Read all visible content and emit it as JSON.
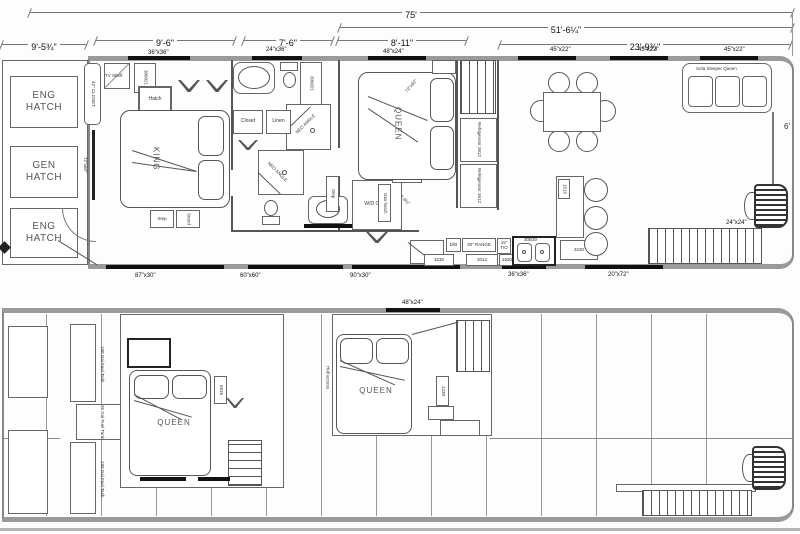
{
  "upper_deck": {
    "dims": {
      "overall": "75'",
      "cabin": "51'-6¼\"",
      "bow": "9'-5¾\"",
      "bed1": "9'-6\"",
      "bath": "7'-6\"",
      "bed2": "8'-11\"",
      "salon": "23'-9¾\"",
      "beam": "6'",
      "hall": "2'-6½\""
    },
    "windows_top": {
      "a": "36\"x36\"",
      "b": "24\"x36\"",
      "c": "48\"x24\"",
      "d": "45\"x22\"",
      "e": "45\"x22\"",
      "f": "45\"x22\""
    },
    "windows_bottom": {
      "a": "87\"x30\"",
      "b": "60\"x60\"",
      "c": "90\"x30\"",
      "d": "36\"x36\"",
      "e": "20\"x72\"",
      "f": "24\"x24\""
    },
    "rooms": {
      "eng_hatch": "ENG HATCH",
      "gen_hatch": "GEN HATCH",
      "closet42": "42\" CLOSET",
      "king": "KING",
      "queen": "QUEEN",
      "closet": "Closet",
      "linen": "Linen",
      "wd_closet": "W/D Closet"
    },
    "furniture": {
      "tv_shelf": "TV Shelf",
      "hatch": "Hatch",
      "shelf": "306021",
      "door": "72\"x60\"",
      "bed_size": "72\"x60\"",
      "shower": "NEO ANGLE",
      "step": "Step",
      "stand": "Stand",
      "gas_hatch": "Gas hatch",
      "range": "30\" RANGE",
      "tall_oven": "15\" T/O",
      "dw": "D/B",
      "sink": "30B30",
      "cab_a": "3230",
      "cab_b": "3012",
      "cab_c": "1530",
      "cab_d": "3230",
      "cab_e": "1515",
      "refrigerator": "Refrigerator 3612",
      "sofa": "Sofa Sleeper Queen"
    }
  },
  "lower_deck": {
    "windows": {
      "a": "48\"x24\""
    },
    "rooms": {
      "queen": "QUEEN",
      "hull_access": "Hull access"
    },
    "tanks": {
      "fuel_190": "190 Gal Fuel Tank",
      "fuel_36": "36 Gal Fuel Tank"
    },
    "furniture": {
      "cab_a": "6915",
      "cab_b": "1230"
    }
  }
}
